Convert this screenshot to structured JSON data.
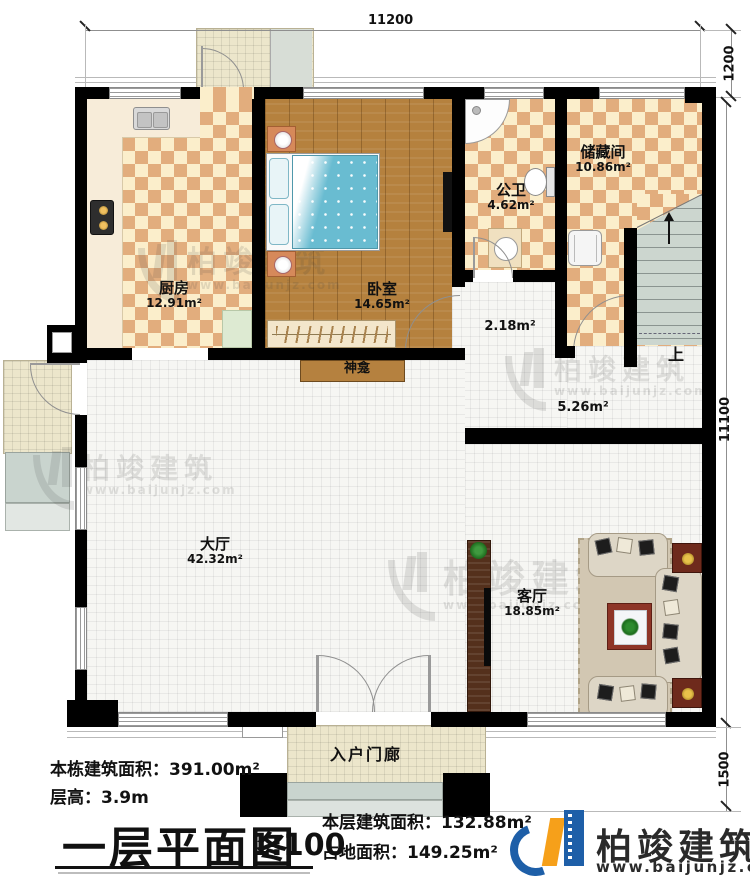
{
  "plan": {
    "dimensions": {
      "top": "11200",
      "right_top": "1200",
      "right_side": "11100",
      "right_bottom": "1500"
    },
    "rooms": {
      "kitchen": {
        "name": "厨房",
        "area": "12.91m²"
      },
      "bedroom": {
        "name": "卧室",
        "area": "14.65m²"
      },
      "bathroom": {
        "name": "公卫",
        "area": "4.62m²"
      },
      "storage": {
        "name": "储藏间",
        "area": "10.86m²"
      },
      "hall": {
        "name": "大厅",
        "area": "42.32m²"
      },
      "living": {
        "name": "客厅",
        "area": "18.85m²"
      },
      "vestibule": {
        "area": "2.18m²"
      },
      "corridor": {
        "area": "5.26m²"
      },
      "shrine": {
        "name": "神龛"
      },
      "stairs_up": {
        "label": "上"
      },
      "entry_porch": {
        "name": "入户门廊"
      }
    },
    "footer": {
      "total_area": "本栋建筑面积：391.00m²",
      "floor_height": "层高：3.9m",
      "title": "一层平面图",
      "scale": "1:100",
      "floor_area": "本层建筑面积：132.88m²",
      "footprint_area": "占地面积：149.25m²"
    },
    "logo": {
      "name": "柏竣建筑",
      "url": "www.baijunjz.com"
    },
    "watermark": {
      "name": "柏竣建筑",
      "url": "www.baijunjz.com"
    }
  }
}
